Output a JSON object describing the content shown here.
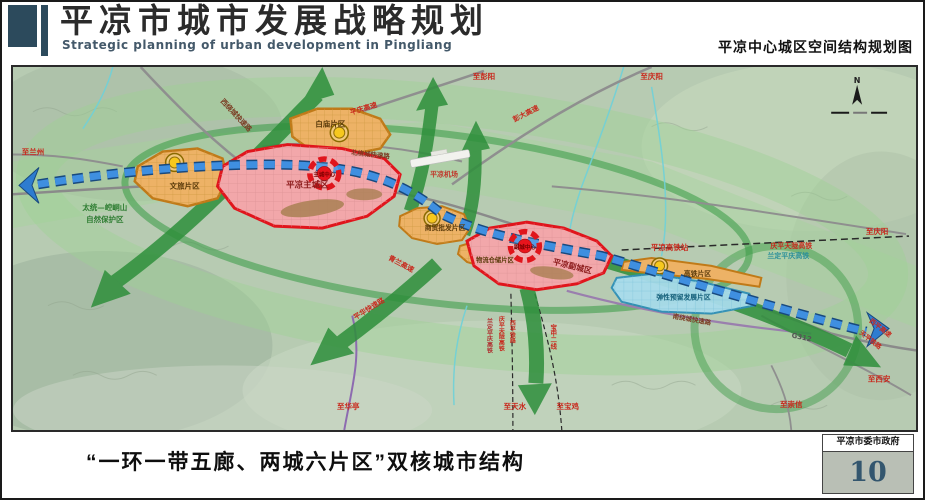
{
  "header": {
    "title": "平凉市城市发展战略规划",
    "subtitle_en": "Strategic planning of urban development in Pingliang",
    "right_caption": "平凉中心城区空间结构规划图"
  },
  "footer": {
    "caption": "“一环一带五廊、两城六片区”双核城市结构",
    "agency": "平凉市委市政府",
    "page_number": "10"
  },
  "compass": {
    "north": "N"
  },
  "colors": {
    "brand_dark": "#2c4a5c",
    "core_red": "#e0151c",
    "city_pink": "#f2a7aa",
    "corridor_green": "#2e8f3b",
    "eco_ring_green": "#9ed193",
    "belt_blue": "#2e7cd0",
    "zone_orange": "#edb266",
    "reserve_blue": "#a9dcec",
    "page_number_blue": "#33566e"
  },
  "map": {
    "cores": {
      "main_city": "平凉主城区",
      "main_core": "主城中心",
      "sub_city": "平凉副城区",
      "sub_core": "副城中心"
    },
    "districts": {
      "wenlv": "文旅片区",
      "baimiao": "白庙片区",
      "shangmao": "商贸批发片区",
      "wuliu": "物流仓储片区",
      "gaotie": "高铁片区",
      "tanxing": "弹性预留发展片区"
    },
    "roads": {
      "west_ring": "西绕城快速路",
      "north_ring": "北绕城快速路",
      "south_ring": "南绕城快速路",
      "pingqing": "平庆高速",
      "pengda": "彭大高速",
      "qinglan": "青兰高速",
      "pinghua": "平华快速路",
      "xiping": "西平高速",
      "g312": "G312"
    },
    "railways": {
      "station": "平凉高铁站",
      "qptl": "庆平天陇高铁",
      "ldpq": "兰定平庆高铁",
      "xiping_rail": "西平铁路",
      "tianping": "天平铁路",
      "baozhong": "宝中二线"
    },
    "places": {
      "airport": "平凉机场",
      "reserve_line1": "太统—崆峒山",
      "reserve_line2": "自然保护区"
    },
    "directions": {
      "lanzhou": "至兰州",
      "pengyang": "至彭阳",
      "qingyang_top": "至庆阳",
      "qingyang_east": "至庆阳",
      "xian": "至西安",
      "chongxin": "至崇信",
      "huating": "至华亭",
      "tianshui": "至天水",
      "baoji": "至宝鸡"
    }
  }
}
